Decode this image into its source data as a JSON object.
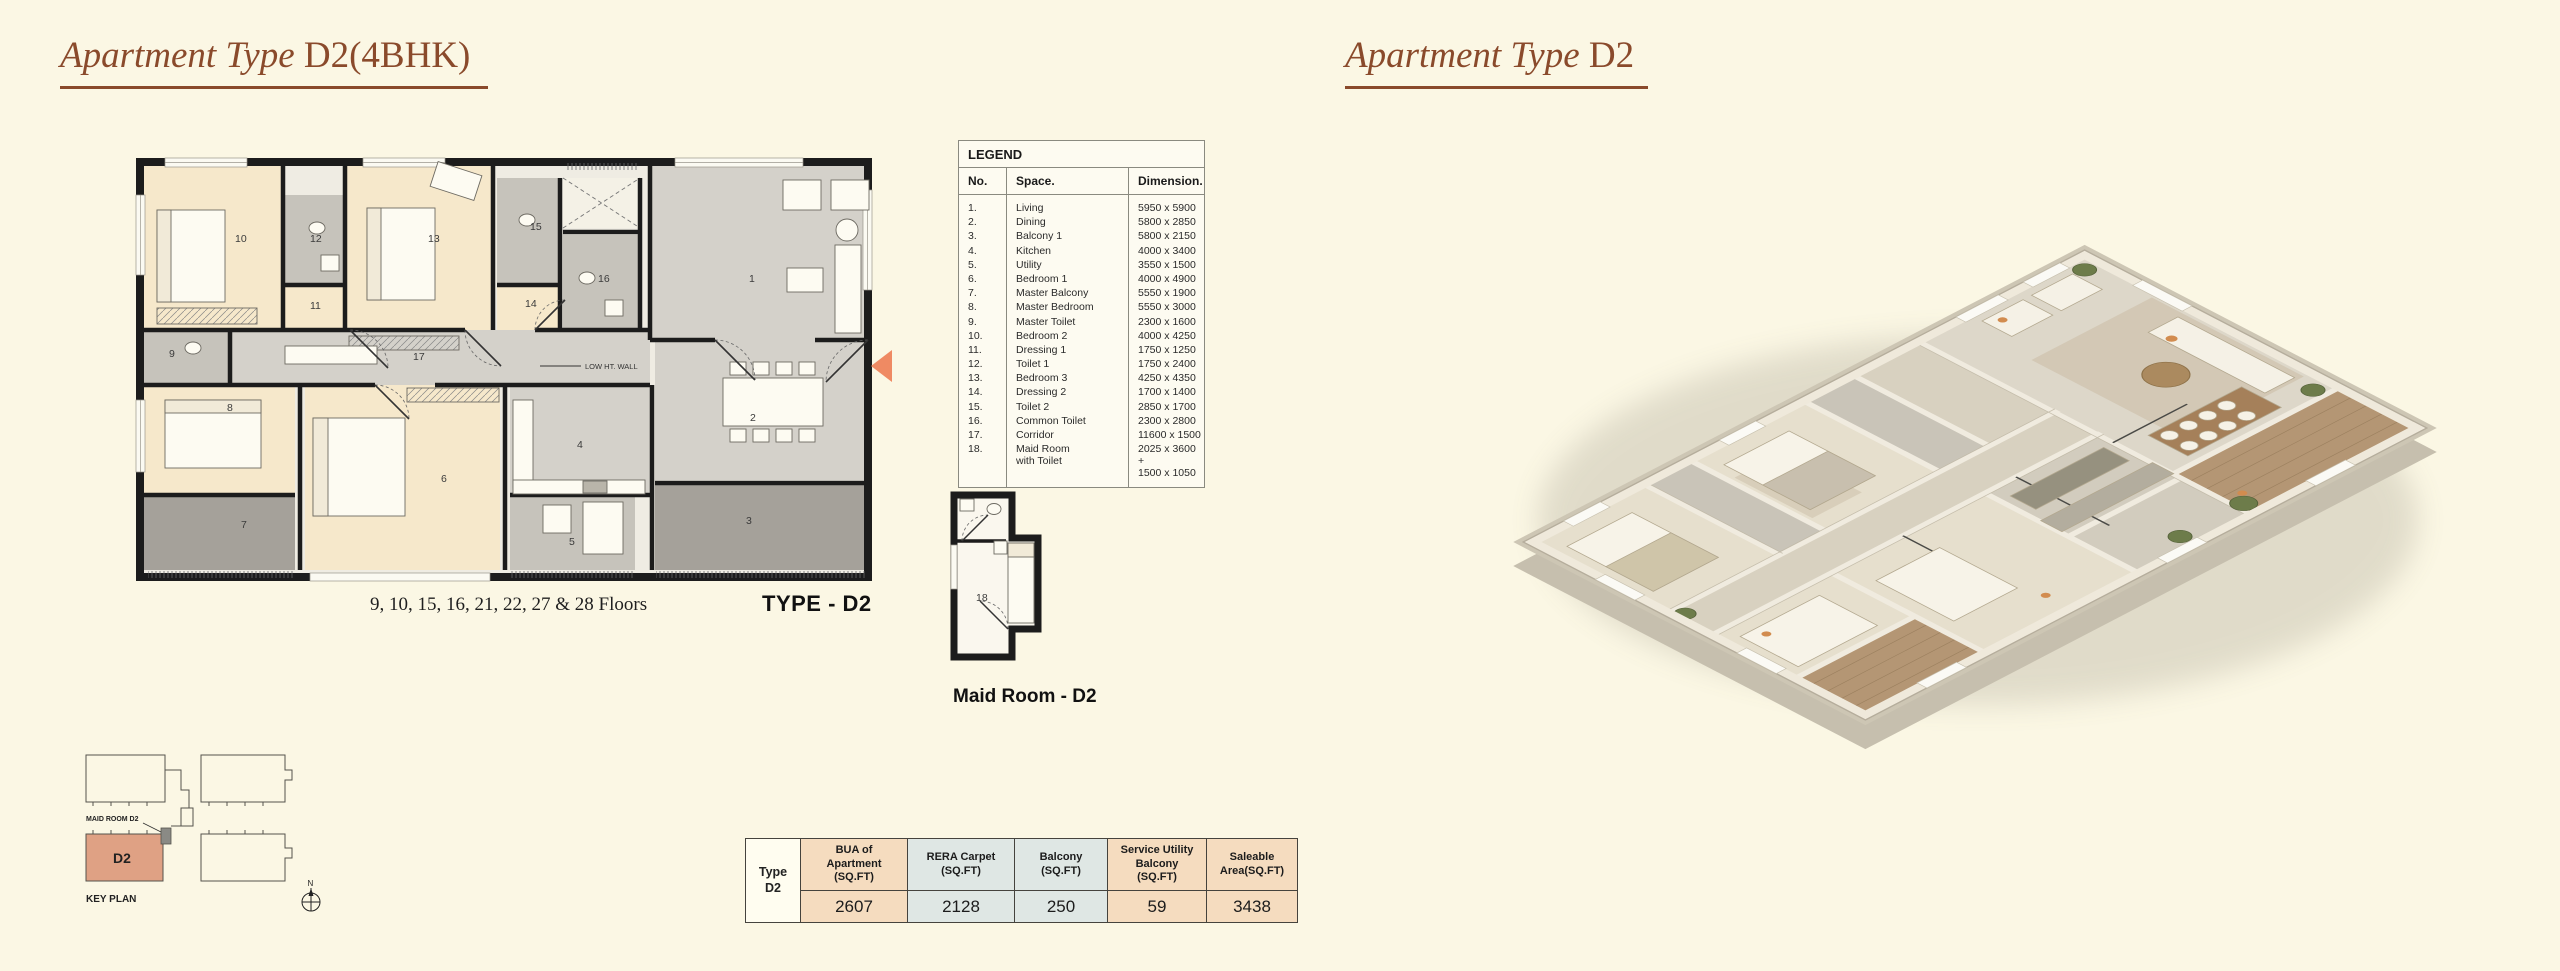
{
  "left_section": {
    "title_em": "Apartment Type ",
    "title_main": "D2(4BHK)",
    "floors_note": "9, 10, 15, 16, 21, 22, 27 & 28 Floors",
    "type_label": "TYPE - D2",
    "low_wall_label": "LOW HT. WALL",
    "plan_room_numbers": [
      "1",
      "2",
      "3",
      "4",
      "5",
      "6",
      "7",
      "8",
      "9",
      "10",
      "11",
      "12",
      "13",
      "14",
      "15",
      "16",
      "17"
    ]
  },
  "right_section": {
    "title_em": "Apartment Type ",
    "title_main": "D2"
  },
  "legend": {
    "title": "LEGEND",
    "columns": [
      "No.",
      "Space.",
      "Dimension."
    ],
    "rows": [
      {
        "no": "1.",
        "space": "Living",
        "dim": "5950 x 5900"
      },
      {
        "no": "2.",
        "space": "Dining",
        "dim": "5800 x 2850"
      },
      {
        "no": "3.",
        "space": "Balcony 1",
        "dim": "5800 x 2150"
      },
      {
        "no": "4.",
        "space": "Kitchen",
        "dim": "4000 x 3400"
      },
      {
        "no": "5.",
        "space": "Utility",
        "dim": "3550 x 1500"
      },
      {
        "no": "6.",
        "space": "Bedroom 1",
        "dim": "4000 x 4900"
      },
      {
        "no": "7.",
        "space": "Master Balcony",
        "dim": "5550 x 1900"
      },
      {
        "no": "8.",
        "space": "Master Bedroom",
        "dim": "5550 x 3000"
      },
      {
        "no": "9.",
        "space": "Master Toilet",
        "dim": "2300 x 1600"
      },
      {
        "no": "10.",
        "space": "Bedroom 2",
        "dim": "4000 x 4250"
      },
      {
        "no": "11.",
        "space": "Dressing 1",
        "dim": "1750 x 1250"
      },
      {
        "no": "12.",
        "space": "Toilet 1",
        "dim": "1750 x 2400"
      },
      {
        "no": "13.",
        "space": "Bedroom 3",
        "dim": "4250 x 4350"
      },
      {
        "no": "14.",
        "space": "Dressing 2",
        "dim": "1700 x 1400"
      },
      {
        "no": "15.",
        "space": "Toilet 2",
        "dim": "2850 x 1700"
      },
      {
        "no": "16.",
        "space": "Common Toilet",
        "dim": "2300 x 2800"
      },
      {
        "no": "17.",
        "space": "Corridor",
        "dim": "11600 x 1500"
      },
      {
        "no": "18.",
        "space": [
          "Maid Room",
          "with Toilet"
        ],
        "dim": [
          "2025 x 3600 +",
          "1500 x 1050"
        ]
      }
    ]
  },
  "maid_plan": {
    "room_number": "18",
    "caption": "Maid Room - D2"
  },
  "key_plan": {
    "maid_label": "MAID ROOM D2",
    "unit_label": "D2",
    "title": "KEY PLAN",
    "compass_letter": "N"
  },
  "area_table": {
    "type_line1": "Type",
    "type_line2": "D2",
    "columns": [
      {
        "header": "BUA of\nApartment\n(SQ.FT)",
        "value": "2607",
        "tone": "peach"
      },
      {
        "header": "RERA Carpet\n(SQ.FT)",
        "value": "2128",
        "tone": "blue"
      },
      {
        "header": "Balcony\n(SQ.FT)",
        "value": "250",
        "tone": "blue"
      },
      {
        "header": "Service Utility\nBalcony\n(SQ.FT)",
        "value": "59",
        "tone": "peach"
      },
      {
        "header": "Saleable\nArea(SQ.FT)",
        "value": "3438",
        "tone": "peach"
      }
    ]
  },
  "colors": {
    "page_bg": "#fbf7e4",
    "title_brown": "#8a4a2b",
    "wall_black": "#1c1c1c",
    "room_cream": "#f6e8cb",
    "room_gray": "#d4d1ca",
    "toilet_gray": "#c6c3bb",
    "balcony_gray": "#a5a19a",
    "keyplan_salmon": "#dfa184",
    "entry_arrow": "#ef8a63",
    "table_peach": "#f5dcbf",
    "table_blue": "#dfe7e4"
  }
}
